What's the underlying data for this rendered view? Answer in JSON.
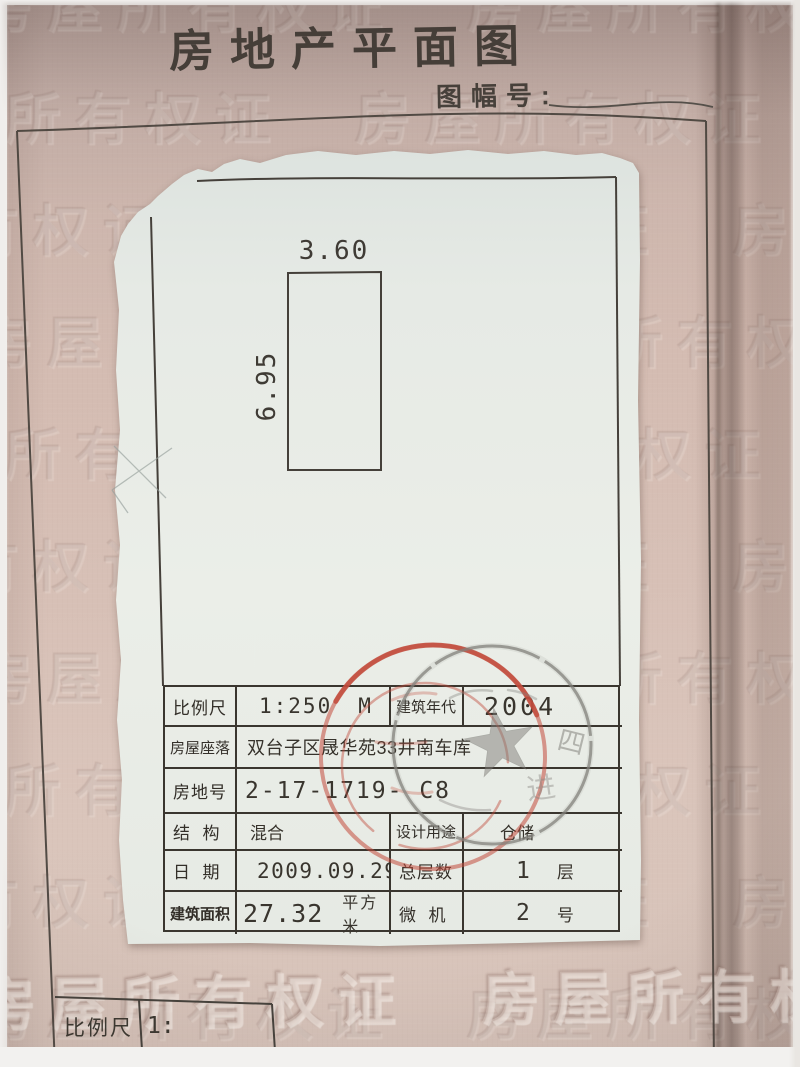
{
  "document": {
    "title": "房地产平面图",
    "sheet_no_label": "图幅号:",
    "watermark_text": "房屋所有权证"
  },
  "plan": {
    "width_dim": "3.60",
    "height_dim": "6.95"
  },
  "info_table": {
    "rows": [
      {
        "label": "比例尺",
        "value": "1:250",
        "unit": "M",
        "label2": "建筑年代",
        "value2": "2004"
      },
      {
        "label": "房屋座落",
        "value": "双台子区晟华苑33井南车库"
      },
      {
        "label": "房地号",
        "value": "2-17-1719- C8"
      },
      {
        "label": "结  构",
        "value": "混合",
        "label2": "设计用途",
        "value2": "仓储"
      },
      {
        "label": "日  期",
        "value": "2009.09.29",
        "label2": "总层数",
        "value2": "1",
        "unit2": "层"
      },
      {
        "label": "建筑面积",
        "value": "27.32",
        "unit": "平方米",
        "label2": "微  机",
        "value2": "2",
        "unit2": "号"
      }
    ]
  },
  "bottom_table": {
    "scale_label": "比例尺",
    "scale_value": "1:"
  },
  "stamp": {
    "glyph_top": "四",
    "glyph_right": "进"
  },
  "colors": {
    "paper_pink": "#d2bab0",
    "sheet_white": "#e8ece6",
    "line_dark": "#45403a",
    "stamp_red": "#c24b3c",
    "stamp_gray": "#83817c"
  }
}
